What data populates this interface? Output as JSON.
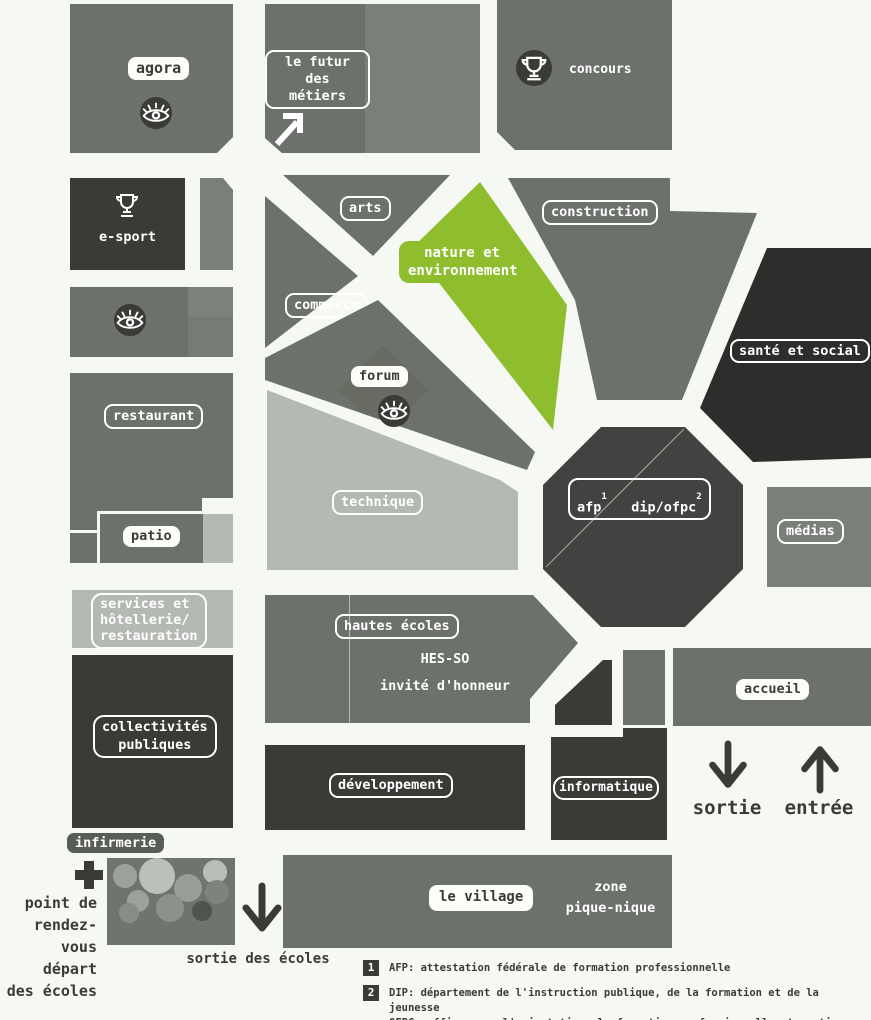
{
  "palette": {
    "background": "#f5f8f3",
    "gray": "#6d716c",
    "gray_light_variant": "#7b7f7a",
    "light_gray": "#b5b9b3",
    "dark": "#3a3b37",
    "darkest": "#2d2e2b",
    "octagon": "#424341",
    "green": "#8ebe2d",
    "white": "#fdfef9"
  },
  "labels": {
    "agora": "agora",
    "futur": "le futur\ndes métiers",
    "concours": "concours",
    "esport": "e-sport",
    "arts": "arts",
    "commerce": "commerce",
    "nature": "nature et\nenvironnement",
    "construction": "construction",
    "sante": "santé et social",
    "forum": "forum",
    "restaurant": "restaurant",
    "patio": "patio",
    "technique": "technique",
    "afp": "afp",
    "afp_sup": "1",
    "dip": "dip/ofpc",
    "dip_sup": "2",
    "medias": "médias",
    "services": "services et\nhôtellerie/\nrestauration",
    "collectivites": "collectivités\npubliques",
    "hautes": "hautes écoles",
    "hesso": "HES-SO\ninvité d'honneur",
    "accueil": "accueil",
    "developpement": "développement",
    "informatique": "informatique",
    "sortie": "sortie",
    "entree": "entrée",
    "infirmerie": "infirmerie",
    "rdv": "point de\nrendez-vous\ndépart\ndes écoles",
    "sortie_ecoles": "sortie des écoles",
    "village": "le village",
    "zone": "zone\npique-nique"
  },
  "footnotes": [
    {
      "num": "1",
      "text": "AFP: attestation fédérale de formation professionnelle"
    },
    {
      "num": "2",
      "text": "DIP: département de l'instruction publique, de la formation et de la jeunesse\nOFPC: office pour l'orientation, la formation professionnelle et continue"
    }
  ]
}
